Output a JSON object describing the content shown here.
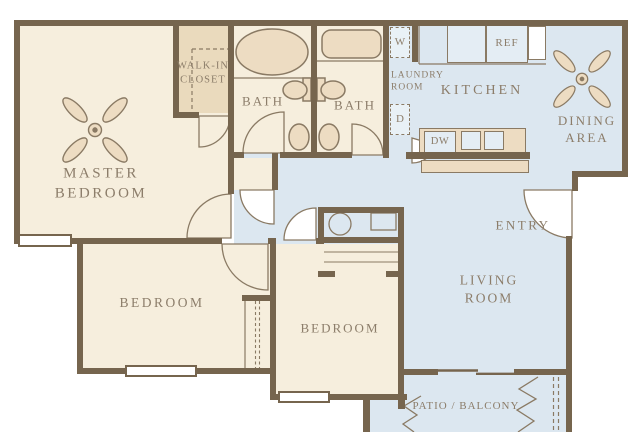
{
  "rooms": {
    "master_bedroom": "MASTER BEDROOM",
    "walk_in_closet": "WALK-IN CLOSET",
    "bath_left": "BATH",
    "bath_right": "BATH",
    "laundry_room": "LAUNDRY ROOM",
    "kitchen": "KITCHEN",
    "dining_area": "DINING AREA",
    "entry": "ENTRY",
    "living_room": "LIVING ROOM",
    "bedroom_left": "BEDROOM",
    "bedroom_middle": "BEDROOM",
    "patio": "PATIO / BALCONY"
  },
  "appliances": {
    "washer": "W",
    "dryer": "D",
    "refrigerator": "REF",
    "dishwasher": "DW"
  },
  "colors": {
    "wall": "#76654e",
    "room_fill": "#f6eedd",
    "closet_fill": "#eadabd",
    "living_fill": "#dce7f0",
    "appliance_fill": "#e4edf4",
    "outline": "#8a7a64",
    "text": "#8c7d6a",
    "background": "#ffffff"
  }
}
